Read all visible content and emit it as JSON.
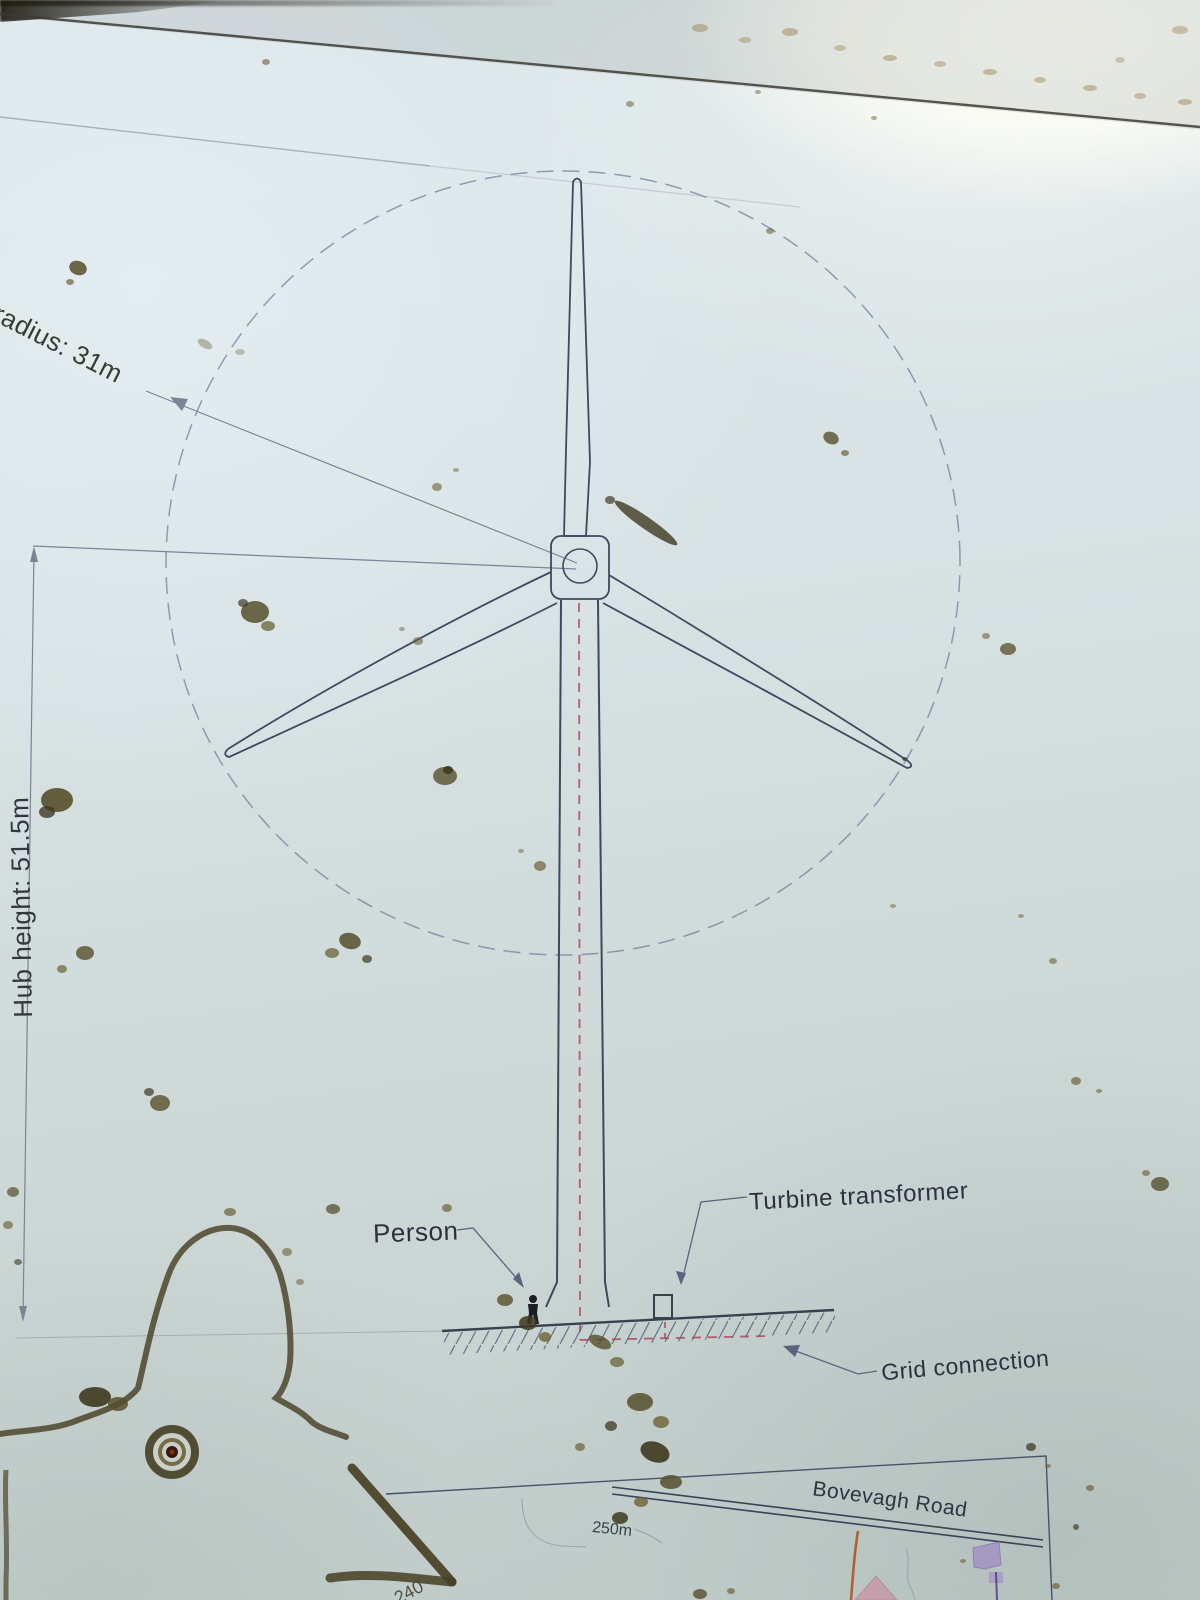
{
  "sign": {
    "description": "Weathered interpretation panel showing a wind turbine elevation drawing above a small location map"
  },
  "labels": {
    "rotor_radius": "radius: 31m",
    "hub_height": "Hub height: 51.5m",
    "person": "Person",
    "turbine_transformer": "Turbine transformer",
    "grid_connection": "Grid connection"
  },
  "map": {
    "road_name": "Bovevagh Road",
    "contour_label_250": "250m",
    "contour_label_240": "240"
  },
  "colors": {
    "drawing_line": "#3f4860",
    "dimension_line": "#7a8398",
    "red_dashed_grid_cable": "#b0485a",
    "map_road_orange": "#b35226",
    "map_building_purple": "#a393c2",
    "map_building_pink": "#c69daa",
    "sign_surface": "#d6e0e2",
    "dirt": "#564f2c"
  }
}
